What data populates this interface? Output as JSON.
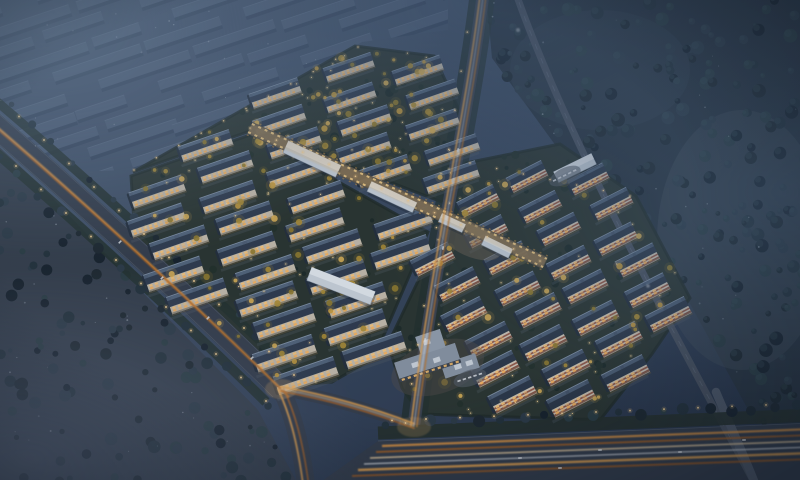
{
  "scene": {
    "title": "Aerial dusk rendering of a residential development with illuminated apartment clusters, arterial roads with light trails, and foggy woodland",
    "time_of_day": "dusk-night",
    "view": "high oblique bird's-eye",
    "features": [
      "west cluster of white slab apartment blocks with dark roofs and warm lit windows",
      "east cluster of brick-and-white apartment blocks with rooftop panels",
      "lit commercial pedestrian street with white canopy roofs crossing the site",
      "ghosted unlit building massing fading into fog to the northwest",
      "diagonal arterial avenue with amber traffic light trails",
      "central north-south road meeting a multi-lane expressway along the bottom",
      "elevated bypass road cutting through dark woodland on the east",
      "gold autumn trees and garden lamps inside the clusters",
      "street lamps along all roads",
      "blue night fog over the corners and the eastern forest"
    ]
  },
  "palette": {
    "sky_top": "#4e6076",
    "sky_mid": "#3c4c62",
    "sky_deep": "#263346",
    "fog_blue": "#63788f",
    "ghost_roof": "#54667e",
    "ghost_side": "#33435a",
    "asphalt": "#343d4a",
    "road_edge": "#5a6472",
    "trail_amber": "#f0a94e",
    "trail_deep": "#b4651f",
    "trail_pale": "#f7d9a8",
    "headlight_white": "#e4e7ea",
    "roof_dark": "#2f3c4e",
    "roof_ridge": "#8fa0b4",
    "roof_panel": "#5d7089",
    "facade_warm": "#c8bfae",
    "facade_white": "#d3c9b8",
    "window_glow": "#ffc979",
    "window_deep": "#ffb75e",
    "brick": "#91503c",
    "canopy_white": "#cdd6de",
    "lawn_dark": "#2a352f",
    "foliage_dark": "#1c272d",
    "foliage_teal": "#2a3d42",
    "foliage_gold": "#c79d3e",
    "lamp_warm": "#ffd998",
    "meadow_gray": "#45525c"
  }
}
